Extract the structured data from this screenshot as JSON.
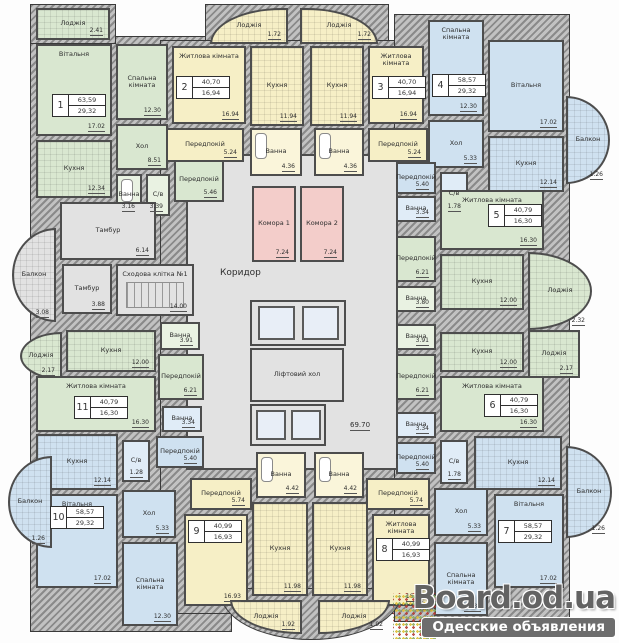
{
  "plan": {
    "width": 619,
    "height": 643
  },
  "colors": {
    "wall": "#4d4d4d",
    "green_apartment": "#d9e7d0",
    "yellow_apartment": "#f6efc6",
    "blue_apartment": "#cfe1f0",
    "storage_pink": "#f3cdca",
    "common_gray": "#e2e2e2"
  },
  "watermark": {
    "site": "Board.od.ua",
    "tagline": "Одесские объявления"
  },
  "free_labels": [
    {
      "t": "Коридор",
      "x": 220,
      "y": 268,
      "s": 9,
      "u": 0
    },
    {
      "t": "69.70",
      "x": 350,
      "y": 421,
      "s": 7,
      "u": 1
    }
  ],
  "apartments": [
    {
      "num": "1",
      "total": "63,59",
      "living": "29,32",
      "x": 52,
      "y": 94
    },
    {
      "num": "2",
      "total": "40,70",
      "living": "16,94",
      "x": 176,
      "y": 76
    },
    {
      "num": "3",
      "total": "40,70",
      "living": "16,94",
      "x": 372,
      "y": 76
    },
    {
      "num": "4",
      "total": "58,57",
      "living": "29,32",
      "x": 432,
      "y": 74
    },
    {
      "num": "5",
      "total": "40,79",
      "living": "16,30",
      "x": 488,
      "y": 204
    },
    {
      "num": "6",
      "total": "40,79",
      "living": "16,30",
      "x": 484,
      "y": 394
    },
    {
      "num": "7",
      "total": "58,57",
      "living": "29,32",
      "x": 498,
      "y": 520
    },
    {
      "num": "8",
      "total": "40,99",
      "living": "16,93",
      "x": 376,
      "y": 538
    },
    {
      "num": "9",
      "total": "40,99",
      "living": "16,93",
      "x": 188,
      "y": 520
    },
    {
      "num": "10",
      "total": "58,57",
      "living": "29,32",
      "x": 50,
      "y": 506
    },
    {
      "num": "11",
      "total": "40,79",
      "living": "16,30",
      "x": 74,
      "y": 396
    }
  ],
  "rooms": [
    {
      "id": "corridor",
      "label": "",
      "area": "",
      "x": 186,
      "y": 154,
      "w": 212,
      "h": 316,
      "fill": "gray"
    },
    {
      "id": "loggia-apt1",
      "label": "Лоджія",
      "area": "2.41",
      "x": 36,
      "y": 8,
      "w": 74,
      "h": 32,
      "fill": "green",
      "grid": 1
    },
    {
      "id": "living-room-apt1",
      "label": "Вітальня",
      "area": "17.02",
      "x": 36,
      "y": 44,
      "w": 76,
      "h": 92,
      "fill": "green",
      "lt": 1
    },
    {
      "id": "bedroom-apt1",
      "label": "Спальна кімната",
      "area": "12.30",
      "x": 116,
      "y": 44,
      "w": 52,
      "h": 76,
      "fill": "green"
    },
    {
      "id": "kitchen-apt1",
      "label": "Кухня",
      "area": "12.34",
      "x": 36,
      "y": 140,
      "w": 76,
      "h": 58,
      "fill": "green",
      "grid": 1
    },
    {
      "id": "hall-apt1",
      "label": "Хол",
      "area": "8.51",
      "x": 116,
      "y": 124,
      "w": 52,
      "h": 46,
      "fill": "green"
    },
    {
      "id": "bathroom-apt1",
      "label": "Ванна",
      "area": "3.16",
      "x": 116,
      "y": 174,
      "w": 26,
      "h": 42,
      "fill": "greenl",
      "feature": "bath"
    },
    {
      "id": "wc-apt1",
      "label": "С/в",
      "area": "3.39",
      "x": 146,
      "y": 174,
      "w": 24,
      "h": 42,
      "fill": "greenl"
    },
    {
      "id": "hallway-apt1",
      "label": "Передпокій",
      "area": "5.46",
      "x": 174,
      "y": 158,
      "w": 50,
      "h": 44,
      "fill": "green"
    },
    {
      "id": "loggia-apt2",
      "label": "Лоджія",
      "area": "1.72",
      "x": 210,
      "y": 8,
      "w": 78,
      "h": 36,
      "fill": "yellow",
      "grid": 1,
      "r": "tl"
    },
    {
      "id": "living-room-apt2",
      "label": "Житлова кімната",
      "area": "16.94",
      "x": 172,
      "y": 46,
      "w": 74,
      "h": 78,
      "fill": "yellow",
      "lt": 1
    },
    {
      "id": "kitchen-apt2",
      "label": "Кухня",
      "area": "11.94",
      "x": 250,
      "y": 46,
      "w": 54,
      "h": 80,
      "fill": "yellow",
      "grid": 1
    },
    {
      "id": "hallway-apt2",
      "label": "Передпокій",
      "area": "5.24",
      "x": 166,
      "y": 128,
      "w": 78,
      "h": 34,
      "fill": "yellow"
    },
    {
      "id": "bathroom-apt2",
      "label": "Ванна",
      "area": "4.36",
      "x": 250,
      "y": 128,
      "w": 52,
      "h": 48,
      "fill": "yellowl",
      "feature": "bath"
    },
    {
      "id": "loggia-apt3",
      "label": "Лоджія",
      "area": "1.72",
      "x": 300,
      "y": 8,
      "w": 78,
      "h": 36,
      "fill": "yellow",
      "grid": 1,
      "r": "tr"
    },
    {
      "id": "kitchen-apt3",
      "label": "Кухня",
      "area": "11.94",
      "x": 310,
      "y": 46,
      "w": 54,
      "h": 80,
      "fill": "yellow",
      "grid": 1
    },
    {
      "id": "living-room-apt3",
      "label": "Житлова кімната",
      "area": "16.94",
      "x": 368,
      "y": 46,
      "w": 56,
      "h": 78,
      "fill": "yellow",
      "lt": 1
    },
    {
      "id": "hallway-apt3",
      "label": "Передпокій",
      "area": "5.24",
      "x": 368,
      "y": 128,
      "w": 60,
      "h": 34,
      "fill": "yellow"
    },
    {
      "id": "bathroom-apt3",
      "label": "Ванна",
      "area": "4.36",
      "x": 314,
      "y": 128,
      "w": 50,
      "h": 48,
      "fill": "yellowl",
      "feature": "bath"
    },
    {
      "id": "bedroom-apt4",
      "label": "Спальна кімната",
      "area": "12.30",
      "x": 428,
      "y": 20,
      "w": 56,
      "h": 96,
      "fill": "blue",
      "lt": 1
    },
    {
      "id": "living-room-apt4",
      "label": "Вітальня",
      "area": "17.02",
      "x": 488,
      "y": 40,
      "w": 76,
      "h": 92,
      "fill": "blue"
    },
    {
      "id": "balcony-apt4",
      "label": "Балкон",
      "area": "1.26",
      "x": 566,
      "y": 96,
      "w": 44,
      "h": 88,
      "fill": "blue",
      "grid": 1,
      "r": "r"
    },
    {
      "id": "hall-apt4",
      "label": "Хол",
      "area": "5.33",
      "x": 428,
      "y": 120,
      "w": 56,
      "h": 48,
      "fill": "blue"
    },
    {
      "id": "kitchen-apt4",
      "label": "Кухня",
      "area": "12.14",
      "x": 488,
      "y": 136,
      "w": 76,
      "h": 56,
      "fill": "blue",
      "grid": 1
    },
    {
      "id": "wc-apt4",
      "label": "С/в",
      "area": "1.78",
      "x": 440,
      "y": 172,
      "w": 28,
      "h": 44,
      "fill": "bluel"
    },
    {
      "id": "hallway-apt4",
      "label": "Передпокій",
      "area": "5.40",
      "x": 396,
      "y": 162,
      "w": 40,
      "h": 32,
      "fill": "blue"
    },
    {
      "id": "bathroom-apt4",
      "label": "Ванна",
      "area": "3.34",
      "x": 396,
      "y": 196,
      "w": 40,
      "h": 26,
      "fill": "bluel"
    },
    {
      "id": "living-room-apt5",
      "label": "Житлова кімната",
      "area": "16.30",
      "x": 440,
      "y": 190,
      "w": 104,
      "h": 60,
      "fill": "green",
      "lt": 1
    },
    {
      "id": "hallway-apt5",
      "label": "Передпокій",
      "area": "6.21",
      "x": 396,
      "y": 236,
      "w": 40,
      "h": 46,
      "fill": "green"
    },
    {
      "id": "kitchen-apt5",
      "label": "Кухня",
      "area": "12.00",
      "x": 440,
      "y": 254,
      "w": 84,
      "h": 56,
      "fill": "green",
      "grid": 1
    },
    {
      "id": "loggia-apt5",
      "label": "Лоджія",
      "area": "2.32",
      "x": 528,
      "y": 252,
      "w": 64,
      "h": 78,
      "fill": "green",
      "grid": 1,
      "r": "r"
    },
    {
      "id": "bathroom-apt5",
      "label": "Ванна",
      "area": "3.80",
      "x": 396,
      "y": 286,
      "w": 40,
      "h": 26,
      "fill": "greenl"
    },
    {
      "id": "bathroom-apt6",
      "label": "Ванна",
      "area": "3.91",
      "x": 396,
      "y": 324,
      "w": 40,
      "h": 26,
      "fill": "greenl"
    },
    {
      "id": "kitchen-apt6",
      "label": "Кухня",
      "area": "12.00",
      "x": 440,
      "y": 332,
      "w": 84,
      "h": 40,
      "fill": "green",
      "grid": 1
    },
    {
      "id": "loggia-apt6",
      "label": "Лоджія",
      "area": "2.17",
      "x": 528,
      "y": 330,
      "w": 52,
      "h": 48,
      "fill": "green",
      "grid": 1
    },
    {
      "id": "hallway-apt6",
      "label": "Передпокій",
      "area": "6.21",
      "x": 396,
      "y": 354,
      "w": 40,
      "h": 46,
      "fill": "green"
    },
    {
      "id": "living-room-apt6",
      "label": "Житлова кімната",
      "area": "16.30",
      "x": 440,
      "y": 376,
      "w": 104,
      "h": 56,
      "fill": "green",
      "lt": 1
    },
    {
      "id": "loggia-apt11",
      "label": "Лоджія",
      "area": "2.17",
      "x": 20,
      "y": 332,
      "w": 42,
      "h": 48,
      "fill": "green",
      "grid": 1,
      "r": "l"
    },
    {
      "id": "kitchen-apt11",
      "label": "Кухня",
      "area": "12.00",
      "x": 66,
      "y": 330,
      "w": 90,
      "h": 42,
      "fill": "green",
      "grid": 1
    },
    {
      "id": "bathroom-apt11",
      "label": "Ванна",
      "area": "3.91",
      "x": 160,
      "y": 322,
      "w": 40,
      "h": 28,
      "fill": "greenl"
    },
    {
      "id": "hallway-apt11",
      "label": "Передпокій",
      "area": "6.21",
      "x": 158,
      "y": 354,
      "w": 46,
      "h": 46,
      "fill": "green"
    },
    {
      "id": "living-room-apt11",
      "label": "Житлова кімната",
      "area": "16.30",
      "x": 36,
      "y": 376,
      "w": 120,
      "h": 56,
      "fill": "green",
      "lt": 1
    },
    {
      "id": "bathroom-apt10",
      "label": "Ванна",
      "area": "3.34",
      "x": 162,
      "y": 406,
      "w": 40,
      "h": 26,
      "fill": "bluel"
    },
    {
      "id": "hallway-apt10",
      "label": "Передпокій",
      "area": "5.40",
      "x": 156,
      "y": 436,
      "w": 48,
      "h": 32,
      "fill": "blue"
    },
    {
      "id": "kitchen-apt10",
      "label": "Кухня",
      "area": "12.14",
      "x": 36,
      "y": 434,
      "w": 82,
      "h": 56,
      "fill": "blue",
      "grid": 1
    },
    {
      "id": "wc-apt10",
      "label": "С/в",
      "area": "1.28",
      "x": 122,
      "y": 440,
      "w": 28,
      "h": 42,
      "fill": "bluel"
    },
    {
      "id": "hall-apt10",
      "label": "Хол",
      "area": "5.33",
      "x": 122,
      "y": 490,
      "w": 54,
      "h": 48,
      "fill": "blue"
    },
    {
      "id": "living-room-apt10",
      "label": "Вітальня",
      "area": "17.02",
      "x": 36,
      "y": 494,
      "w": 82,
      "h": 94,
      "fill": "blue",
      "lt": 1
    },
    {
      "id": "bedroom-apt10",
      "label": "Спальна кімната",
      "area": "12.30",
      "x": 122,
      "y": 542,
      "w": 56,
      "h": 84,
      "fill": "blue"
    },
    {
      "id": "balcony-apt10",
      "label": "Балкон",
      "area": "1.26",
      "x": 8,
      "y": 456,
      "w": 44,
      "h": 92,
      "fill": "blue",
      "grid": 1,
      "r": "l"
    },
    {
      "id": "hallway-apt9",
      "label": "Передпокій",
      "area": "5.74",
      "x": 190,
      "y": 478,
      "w": 62,
      "h": 32,
      "fill": "yellow"
    },
    {
      "id": "bathroom-apt9",
      "label": "Ванна",
      "area": "4.42",
      "x": 256,
      "y": 452,
      "w": 50,
      "h": 46,
      "fill": "yellowl",
      "feature": "bath"
    },
    {
      "id": "living-room-apt9",
      "label": "Житлова кімната",
      "area": "16.93",
      "x": 184,
      "y": 514,
      "w": 64,
      "h": 92,
      "fill": "yellow",
      "lt": 1
    },
    {
      "id": "kitchen-apt9",
      "label": "Кухня",
      "area": "11.98",
      "x": 252,
      "y": 502,
      "w": 56,
      "h": 94,
      "fill": "yellow",
      "grid": 1
    },
    {
      "id": "loggia-apt9",
      "label": "Лоджія",
      "area": "1.92",
      "x": 230,
      "y": 600,
      "w": 72,
      "h": 34,
      "fill": "yellow",
      "grid": 1,
      "r": "bl"
    },
    {
      "id": "bathroom-apt8",
      "label": "Ванна",
      "area": "4.42",
      "x": 314,
      "y": 452,
      "w": 50,
      "h": 46,
      "fill": "yellowl",
      "feature": "bath"
    },
    {
      "id": "hallway-apt8",
      "label": "Передпокій",
      "area": "5.74",
      "x": 366,
      "y": 478,
      "w": 64,
      "h": 32,
      "fill": "yellow"
    },
    {
      "id": "kitchen-apt8",
      "label": "Кухня",
      "area": "11.98",
      "x": 312,
      "y": 502,
      "w": 56,
      "h": 94,
      "fill": "yellow",
      "grid": 1
    },
    {
      "id": "living-room-apt8",
      "label": "Житлова кімната",
      "area": "16.93",
      "x": 372,
      "y": 514,
      "w": 58,
      "h": 92,
      "fill": "yellow",
      "lt": 1
    },
    {
      "id": "loggia-apt8",
      "label": "Лоджія",
      "area": "1.92",
      "x": 318,
      "y": 600,
      "w": 72,
      "h": 34,
      "fill": "yellow",
      "grid": 1,
      "r": "br"
    },
    {
      "id": "bathroom-apt7",
      "label": "Ванна",
      "area": "3.34",
      "x": 396,
      "y": 412,
      "w": 40,
      "h": 26,
      "fill": "bluel"
    },
    {
      "id": "hallway-apt7",
      "label": "Передпокій",
      "area": "5.40",
      "x": 396,
      "y": 442,
      "w": 40,
      "h": 32,
      "fill": "blue"
    },
    {
      "id": "wc-apt7",
      "label": "С/в",
      "area": "1.78",
      "x": 440,
      "y": 440,
      "w": 28,
      "h": 44,
      "fill": "bluel"
    },
    {
      "id": "kitchen-apt7",
      "label": "Кухня",
      "area": "12.14",
      "x": 474,
      "y": 436,
      "w": 88,
      "h": 54,
      "fill": "blue",
      "grid": 1
    },
    {
      "id": "hall-apt7",
      "label": "Хол",
      "area": "5.33",
      "x": 434,
      "y": 488,
      "w": 54,
      "h": 48,
      "fill": "blue"
    },
    {
      "id": "living-room-apt7",
      "label": "Вітальня",
      "area": "17.02",
      "x": 494,
      "y": 494,
      "w": 70,
      "h": 94,
      "fill": "blue",
      "lt": 1
    },
    {
      "id": "bedroom-apt7",
      "label": "Спальна кімната",
      "area": "12.30",
      "x": 434,
      "y": 542,
      "w": 54,
      "h": 74,
      "fill": "blue"
    },
    {
      "id": "balcony-apt7",
      "label": "Балкон",
      "area": "1.26",
      "x": 566,
      "y": 446,
      "w": 46,
      "h": 92,
      "fill": "blue",
      "grid": 1,
      "r": "r"
    },
    {
      "id": "vestibule-1",
      "label": "Тамбур",
      "area": "6.14",
      "x": 60,
      "y": 202,
      "w": 96,
      "h": 58,
      "fill": "gray"
    },
    {
      "id": "common-balcony",
      "label": "Балкон",
      "area": "3.08",
      "x": 12,
      "y": 228,
      "w": 44,
      "h": 94,
      "fill": "gray",
      "grid": 1,
      "r": "l"
    },
    {
      "id": "vestibule-2",
      "label": "Тамбур",
      "area": "3.88",
      "x": 62,
      "y": 264,
      "w": 50,
      "h": 50,
      "fill": "gray"
    },
    {
      "id": "stairwell",
      "label": "Сходова клітка №1",
      "area": "14.00",
      "x": 116,
      "y": 264,
      "w": 78,
      "h": 52,
      "fill": "gray",
      "feature": "stairs",
      "lt": 1
    },
    {
      "id": "storeroom-1",
      "label": "Комора 1",
      "area": "7.24",
      "x": 252,
      "y": 186,
      "w": 44,
      "h": 76,
      "fill": "pink"
    },
    {
      "id": "storeroom-2",
      "label": "Комора 2",
      "area": "7.24",
      "x": 300,
      "y": 186,
      "w": 44,
      "h": 76,
      "fill": "pink"
    },
    {
      "id": "elevator-shafts-top",
      "label": "",
      "area": "",
      "x": 250,
      "y": 300,
      "w": 96,
      "h": 46,
      "fill": "gray",
      "feature": "lifts"
    },
    {
      "id": "elevator-hall",
      "label": "Ліфтовий хол",
      "area": "",
      "x": 250,
      "y": 348,
      "w": 94,
      "h": 54,
      "fill": "gray"
    },
    {
      "id": "elevator-shafts-bottom",
      "label": "",
      "area": "",
      "x": 250,
      "y": 404,
      "w": 76,
      "h": 42,
      "fill": "gray",
      "feature": "lifts"
    }
  ]
}
